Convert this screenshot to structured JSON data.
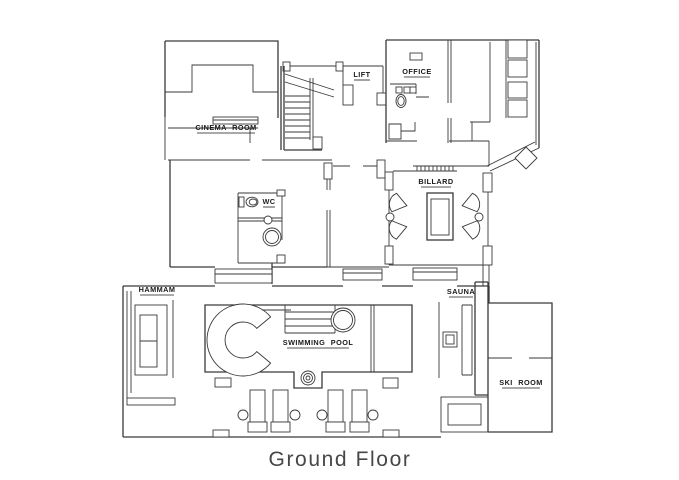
{
  "title": "Ground Floor",
  "plan": {
    "labels": {
      "cinema_room": "CINEMA ROOM",
      "lift": "LIFT",
      "office": "OFFICE",
      "billard": "BILLARD",
      "wc": "WC",
      "hammam": "HAMMAM",
      "sauna": "SAUNA",
      "swimming_pool": "SWIMMING POOL",
      "ski_room": "SKI ROOM"
    },
    "colors": {
      "line": "#3a3a3a",
      "label_text": "#1a1a1a",
      "title_text": "#474747",
      "background": "#ffffff"
    }
  }
}
